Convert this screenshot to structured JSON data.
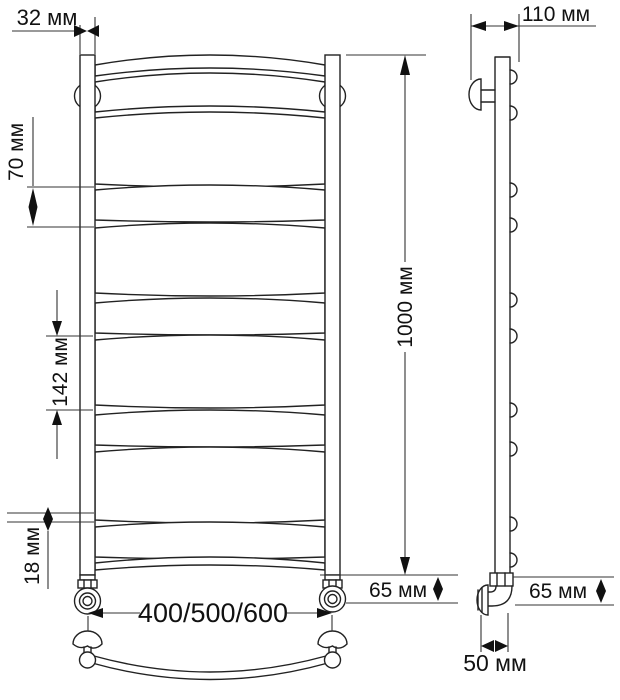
{
  "drawing": {
    "kind": "technical drawing — ladder towel rail (полотенцесушитель), front and side views",
    "background_color": "#ffffff",
    "line_color": "#222222",
    "dimension_line_color": "#333333",
    "text_color": "#111111"
  },
  "front_view": {
    "name": "front view",
    "rail_count": 11,
    "dims": {
      "post_width": "32 мм",
      "pitch_small": "70 мм",
      "pitch_large": "142 мм",
      "tube": "18 мм",
      "height": "1000 мм",
      "widths": "400/500/600",
      "bottom_offset": "65 мм"
    }
  },
  "side_view": {
    "name": "side view",
    "bracket_count": 10,
    "dims": {
      "depth": "110 мм",
      "bottom_offset": "65 мм",
      "wall_clearance": "50 мм"
    }
  }
}
